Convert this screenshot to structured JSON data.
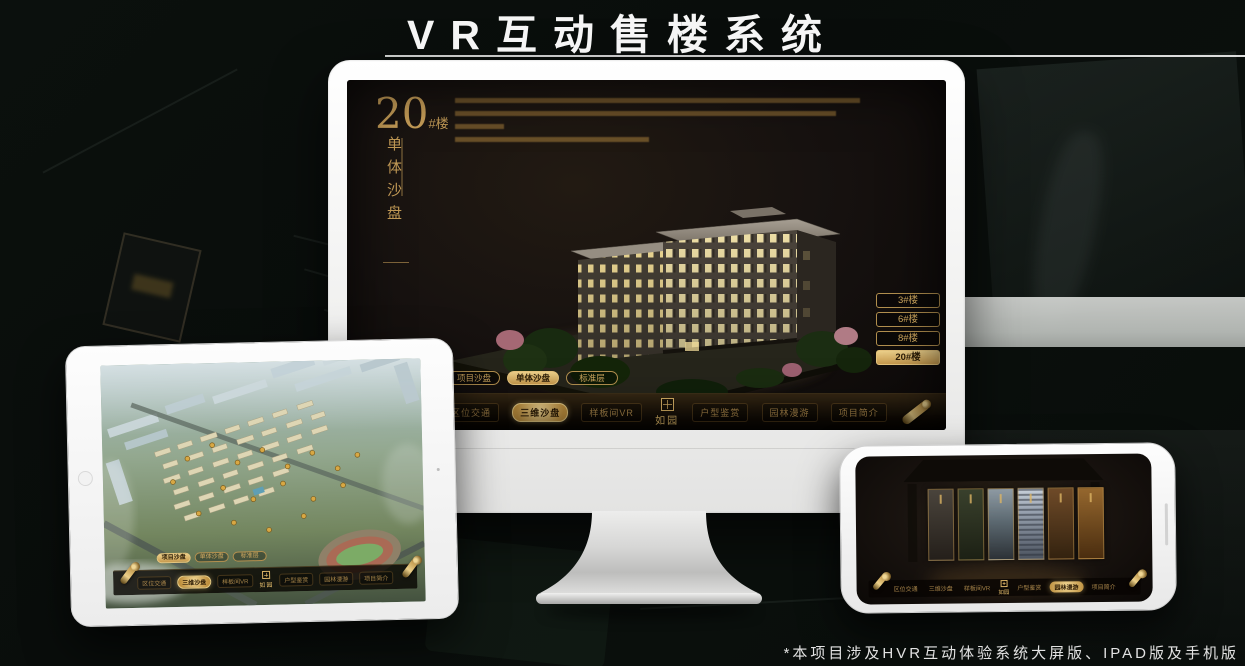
{
  "page": {
    "title": "VR互动售楼系统",
    "footnote": "*本项目涉及HVR互动体验系统大屏版、IPAD版及手机版"
  },
  "colors": {
    "accent_gold": "#c79e58",
    "accent_gold_bright": "#ecd08a",
    "screen_background": "#171210",
    "page_background": "#090d0b",
    "title_text": "#f5f5f5"
  },
  "monitor_app": {
    "heading": {
      "number": "20",
      "unit": "#楼",
      "subtitle_vertical": "单体沙盘"
    },
    "building_buttons": [
      {
        "label": "3#楼",
        "active": false
      },
      {
        "label": "6#楼",
        "active": false
      },
      {
        "label": "8#楼",
        "active": false
      },
      {
        "label": "20#楼",
        "active": true
      }
    ],
    "view_tabs": [
      {
        "label": "项目沙盘",
        "active": false
      },
      {
        "label": "单体沙盘",
        "active": true
      },
      {
        "label": "标准层",
        "active": false
      }
    ],
    "nav": {
      "items": [
        {
          "label": "区位交通",
          "active": false
        },
        {
          "label": "三维沙盘",
          "active": true
        },
        {
          "label": "样板间VR",
          "active": false
        },
        {
          "label": "户型鉴赏",
          "active": false
        },
        {
          "label": "园林漫游",
          "active": false
        },
        {
          "label": "项目简介",
          "active": false
        }
      ],
      "logo": "如园"
    }
  },
  "tablet_app": {
    "view_tabs": [
      {
        "label": "项目沙盘",
        "active": true
      },
      {
        "label": "单体沙盘",
        "active": false
      },
      {
        "label": "标准层",
        "active": false
      }
    ],
    "nav": {
      "items": [
        {
          "label": "区位交通",
          "active": false
        },
        {
          "label": "三维沙盘",
          "active": true
        },
        {
          "label": "样板间VR",
          "active": false
        },
        {
          "label": "户型鉴赏",
          "active": false
        },
        {
          "label": "园林漫游",
          "active": false
        },
        {
          "label": "项目简介",
          "active": false
        }
      ],
      "logo": "如园"
    }
  },
  "phone_app": {
    "nav": {
      "items": [
        {
          "label": "区位交通",
          "active": false
        },
        {
          "label": "三维沙盘",
          "active": false
        },
        {
          "label": "样板间VR",
          "active": false
        },
        {
          "label": "户型鉴赏",
          "active": false
        },
        {
          "label": "园林漫游",
          "active": true
        },
        {
          "label": "项目简介",
          "active": false
        }
      ],
      "logo": "如园"
    }
  }
}
